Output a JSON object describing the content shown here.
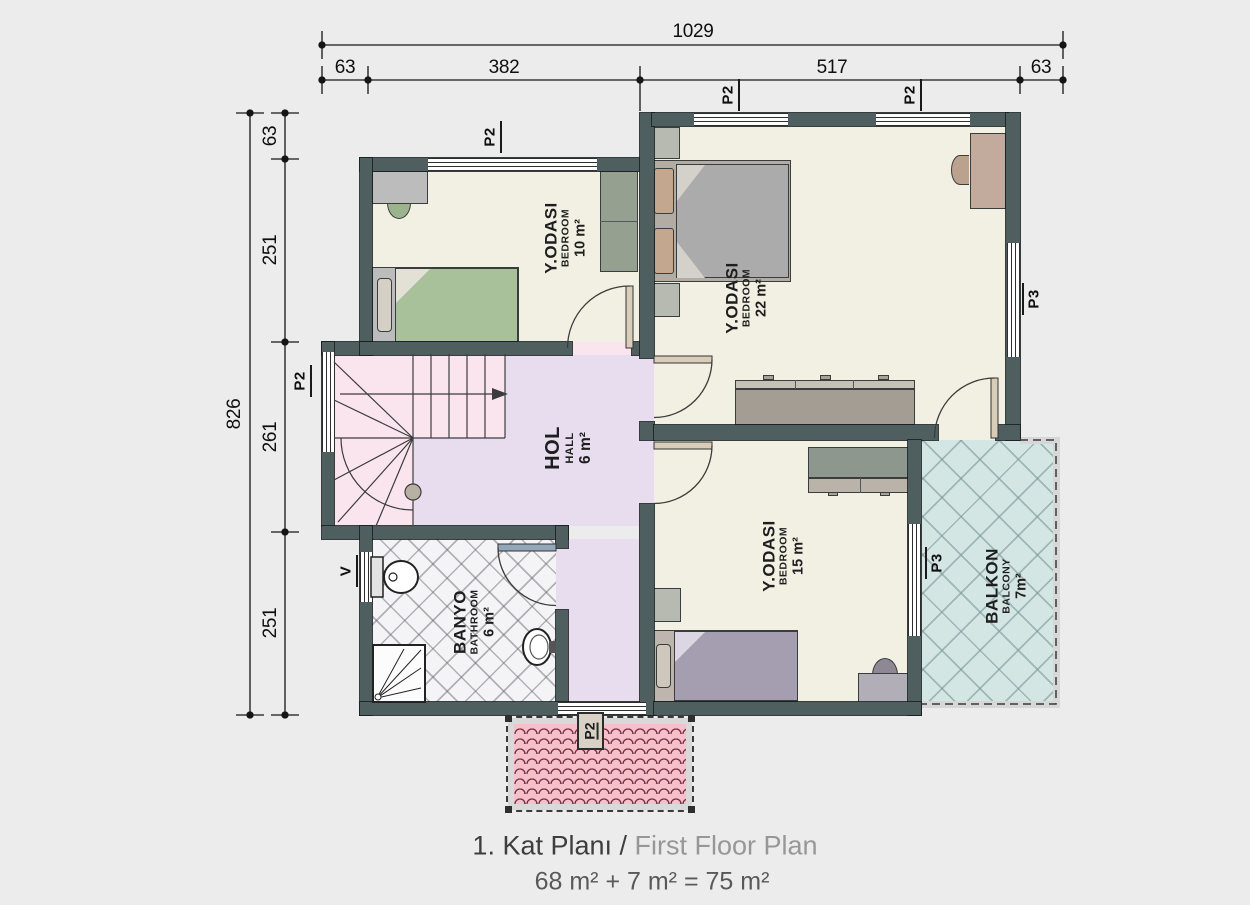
{
  "title": {
    "part1": "1. Kat Planı /",
    "part2": " First Floor Plan",
    "area_formula": "68 m² + 7 m² = 75 m²"
  },
  "dimensions": {
    "top": {
      "total": "1029",
      "segments": [
        "63",
        "382",
        "517",
        "63"
      ]
    },
    "left": {
      "total": "826",
      "segments": [
        "63",
        "251",
        "261",
        "251"
      ]
    }
  },
  "rooms": {
    "bedroom10": {
      "name_tr": "Y.ODASI",
      "name_en": "BEDROOM",
      "area": "10 m²"
    },
    "bedroom22": {
      "name_tr": "Y.ODASI",
      "name_en": "BEDROOM",
      "area": "22 m²"
    },
    "bedroom15": {
      "name_tr": "Y.ODASI",
      "name_en": "BEDROOM",
      "area": "15 m²"
    },
    "hall": {
      "name_tr": "HOL",
      "name_en": "HALL",
      "area": "6 m²"
    },
    "bathroom": {
      "name_tr": "BANYO",
      "name_en": "BATHROOM",
      "area": "6 m²"
    },
    "balcony": {
      "name_tr": "BALKON",
      "name_en": "BALCONY",
      "area": "7m²"
    }
  },
  "tags": {
    "p2": "P2",
    "p3": "P3",
    "v": "V"
  },
  "colors": {
    "background": "#ececec",
    "wall": "#4f5e5f",
    "bedroom_floor": "#f2f0e3",
    "hall_floor": "#e8ddee",
    "stairs_floor": "#fae5ef",
    "bathroom_floor": "#f4f4f6",
    "balcony_floor": "#d3e6e4",
    "canopy_fill": "#f6c0cb",
    "canopy_line": "#7a3448"
  }
}
